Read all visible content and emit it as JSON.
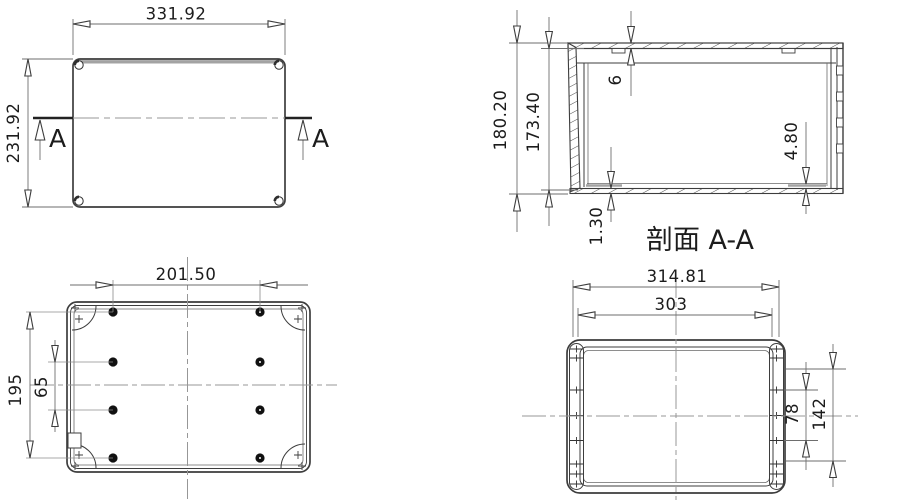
{
  "drawing": {
    "views": {
      "lid_outside": {
        "width": "331.92",
        "height": "231.92",
        "section_marker": "A"
      },
      "section": {
        "title": "剖面 A-A",
        "overall_height": "180.20",
        "internal_height": "173.40",
        "lid_thickness": "6",
        "boss_height": "4.80",
        "bottom_thickness": "1.30"
      },
      "base_inside": {
        "hole_span_horizontal": "201.50",
        "hole_span_vertical": "195",
        "hole_pitch": "65"
      },
      "lid_inside": {
        "overall_width": "314.81",
        "body_width": "303",
        "hole_pitch": "78",
        "hole_span": "142"
      }
    },
    "colors": {
      "outline": "#3d3d3d",
      "dimension": "#6e6e6e",
      "centerline": "#979797",
      "thick_gray": "#a3a3a3"
    }
  }
}
